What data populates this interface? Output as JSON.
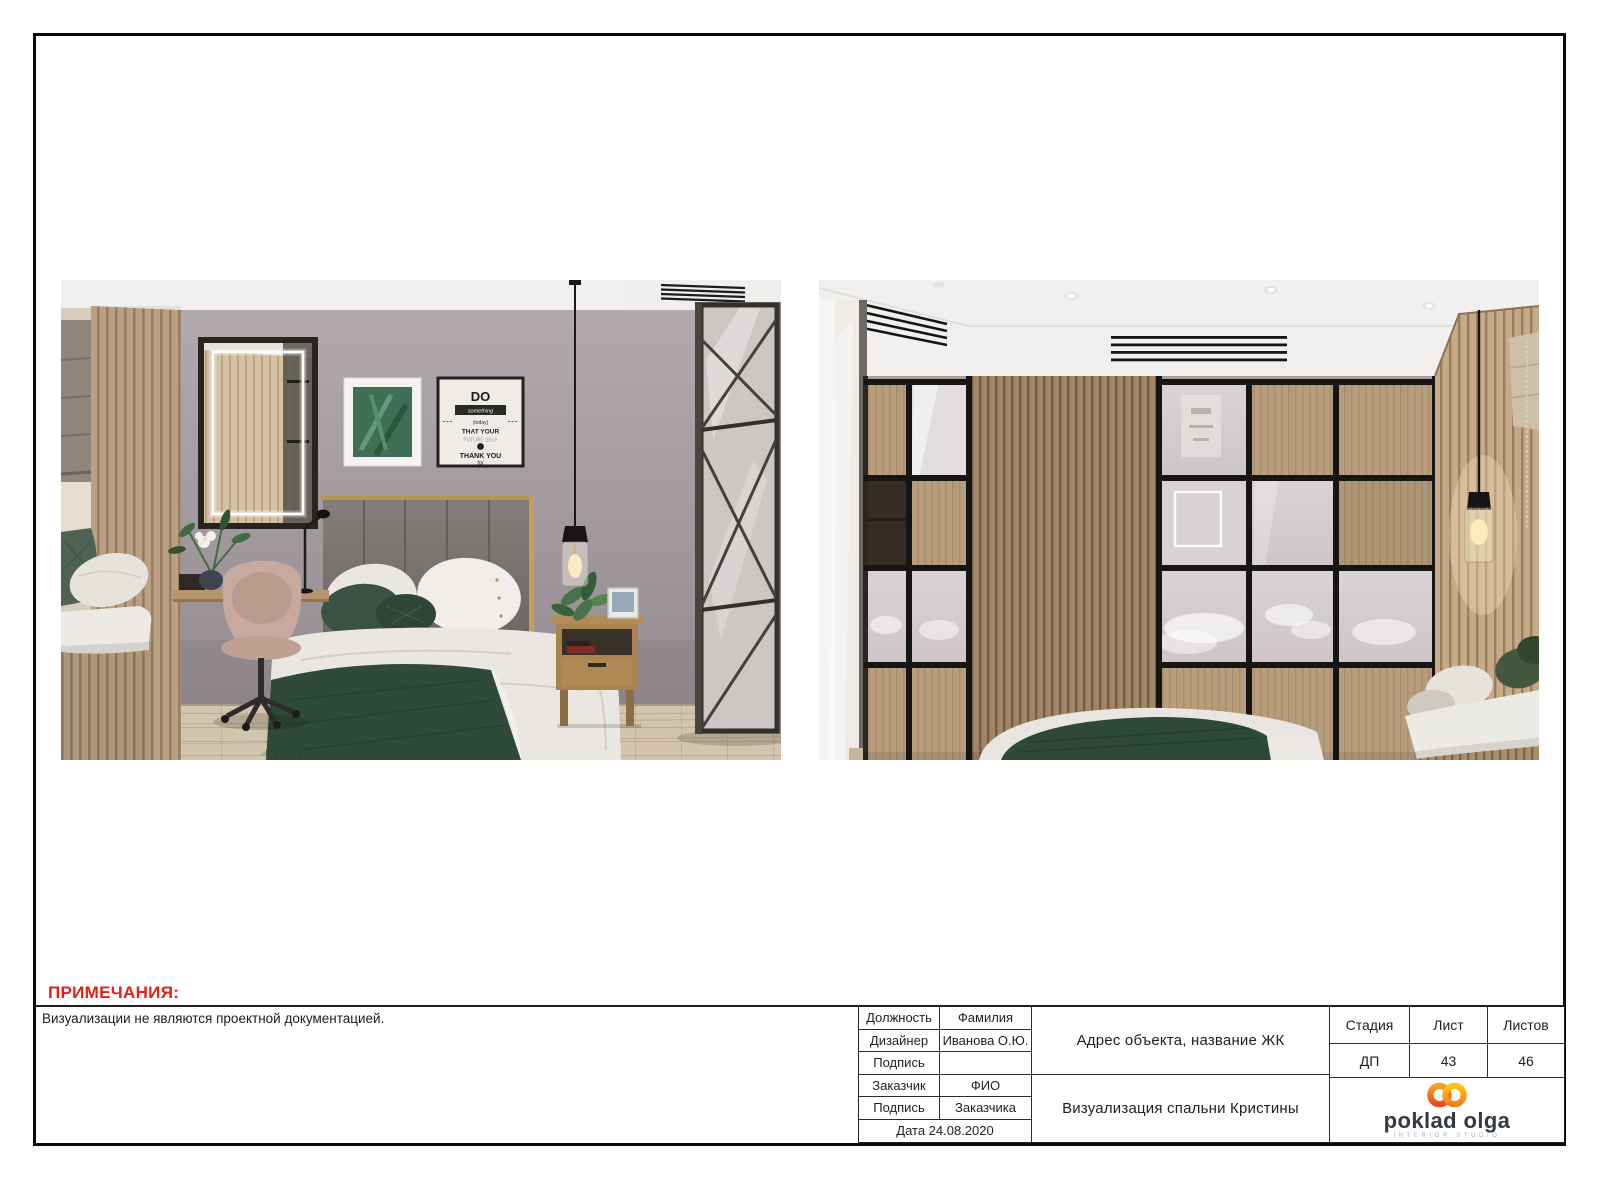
{
  "sheet": {
    "notes_heading": "ПРИМЕЧАНИЯ:",
    "notes_text": "Визуализации не являются проектной документацией.",
    "colors": {
      "accent_red": "#e32119",
      "frame_black": "#0a0a0a",
      "logo_orange_top": "#f9a01b",
      "logo_orange_bottom": "#ef4823",
      "logo_gold_top": "#fdc60b",
      "logo_gold_bottom": "#f47f20",
      "logo_text": "#333a44"
    }
  },
  "renders": {
    "left": {
      "poster": [
        "DO",
        "something",
        "(today)",
        "THAT YOUR",
        "FUTURE SELF",
        "THANK YOU",
        "for"
      ]
    }
  },
  "title_block": {
    "signature_rows": [
      {
        "label": "Должность",
        "value": "Фамилия"
      },
      {
        "label": "Дизайнер",
        "value": "Иванова О.Ю."
      },
      {
        "label": "Подпись",
        "value": ""
      },
      {
        "label": "Заказчик",
        "value": "ФИО"
      },
      {
        "label": "Подпись",
        "value": "Заказчика"
      }
    ],
    "date_row": "Дата 24.08.2020",
    "address": "Адрес объекта, название ЖК",
    "sheet_title": "Визуализация спальни Кристины",
    "stage": {
      "header": "Стадия",
      "value": "ДП"
    },
    "sheet": {
      "header": "Лист",
      "value": "43"
    },
    "sheets_total": {
      "header": "Листов",
      "value": "46"
    },
    "logo": {
      "name": "poklad olga",
      "subtitle": "INTERIOR STUDIO"
    }
  }
}
